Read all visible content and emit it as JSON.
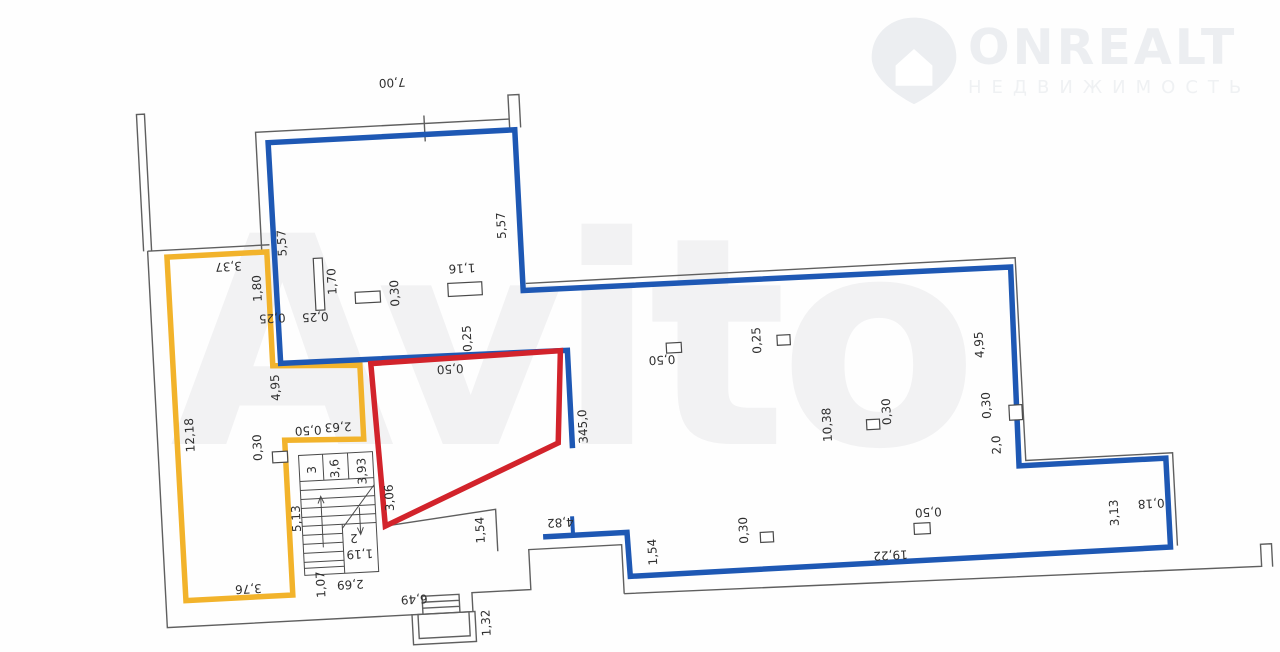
{
  "watermark": {
    "brand": "ONREALT",
    "brand_subtitle": "НЕДВИЖИМОСТЬ",
    "center_text": "Avito"
  },
  "plan": {
    "colors": {
      "blue": "#1e58b4",
      "yellow": "#f2b32b",
      "red": "#d2232b",
      "wall": "#5f5f5f",
      "stair": "#4a4a4a",
      "label": "#2e2e2e",
      "watermark_gray": "#f2f2f3",
      "logo_gray": "#eceef1"
    },
    "area_value": "345,0",
    "labels": [
      {
        "t": "7,00",
        "x": 407,
        "y": 69,
        "r": 180
      },
      {
        "t": "5,57",
        "x": 289,
        "y": 224,
        "r": -90
      },
      {
        "t": "5,57",
        "x": 509,
        "y": 218,
        "r": -90
      },
      {
        "t": "1,70",
        "x": 337,
        "y": 265,
        "r": -90
      },
      {
        "t": "0,30",
        "x": 399,
        "y": 280,
        "r": -90
      },
      {
        "t": "1,16",
        "x": 467,
        "y": 258,
        "r": 180
      },
      {
        "t": "3,37",
        "x": 234,
        "y": 244,
        "r": 180
      },
      {
        "t": "1,80",
        "x": 262,
        "y": 268,
        "r": -90
      },
      {
        "t": "0,25",
        "x": 275,
        "y": 298,
        "r": 180
      },
      {
        "t": "0,25",
        "x": 318,
        "y": 299,
        "r": 180
      },
      {
        "t": "4,95",
        "x": 275,
        "y": 368,
        "r": -90
      },
      {
        "t": "12,18",
        "x": 187,
        "y": 411,
        "r": -90
      },
      {
        "t": "2,63",
        "x": 335,
        "y": 410,
        "r": 180
      },
      {
        "t": "0,50",
        "x": 305,
        "y": 412,
        "r": 180
      },
      {
        "t": "0,30",
        "x": 254,
        "y": 427,
        "r": -90
      },
      {
        "t": "5,13",
        "x": 289,
        "y": 500,
        "r": -90
      },
      {
        "t": "3,76",
        "x": 237,
        "y": 567,
        "r": 180
      },
      {
        "t": "1,07",
        "x": 310,
        "y": 567,
        "r": -90
      },
      {
        "t": "3",
        "x": 307,
        "y": 452,
        "r": -90
      },
      {
        "t": "3,6",
        "x": 330,
        "y": 452,
        "r": -90
      },
      {
        "t": "3,93",
        "x": 357,
        "y": 456,
        "r": -90
      },
      {
        "t": "2",
        "x": 345,
        "y": 522,
        "r": 180
      },
      {
        "t": "1,19",
        "x": 350,
        "y": 538,
        "r": 180
      },
      {
        "t": "2,69",
        "x": 339,
        "y": 568,
        "r": 180
      },
      {
        "t": "6,49",
        "x": 402,
        "y": 586,
        "r": 180
      },
      {
        "t": "1,32",
        "x": 473,
        "y": 614,
        "r": -90
      },
      {
        "t": "1,54",
        "x": 472,
        "y": 521,
        "r": -90
      },
      {
        "t": "4,82",
        "x": 552,
        "y": 517,
        "r": 180
      },
      {
        "t": "1,54",
        "x": 643,
        "y": 552,
        "r": -90
      },
      {
        "t": "3,06",
        "x": 383,
        "y": 484,
        "r": -90
      },
      {
        "t": "345,0",
        "x": 580,
        "y": 423,
        "r": -90
      },
      {
        "t": "0,50",
        "x": 450,
        "y": 358,
        "r": 180
      },
      {
        "t": "0,25",
        "x": 469,
        "y": 329,
        "r": -90
      },
      {
        "t": "0,50",
        "x": 662,
        "y": 360,
        "r": 180
      },
      {
        "t": "0,25",
        "x": 758,
        "y": 346,
        "r": -90
      },
      {
        "t": "10,38",
        "x": 824,
        "y": 434,
        "r": -90
      },
      {
        "t": "0,30",
        "x": 884,
        "y": 424,
        "r": -90
      },
      {
        "t": "4,95",
        "x": 980,
        "y": 362,
        "r": -90
      },
      {
        "t": "0,30",
        "x": 984,
        "y": 423,
        "r": -90
      },
      {
        "t": "2,0",
        "x": 992,
        "y": 463,
        "r": -90
      },
      {
        "t": "0,30",
        "x": 735,
        "y": 535,
        "r": -90
      },
      {
        "t": "0,50",
        "x": 920,
        "y": 526,
        "r": 180
      },
      {
        "t": "19,22",
        "x": 880,
        "y": 567,
        "r": 180
      },
      {
        "t": "3,13",
        "x": 1106,
        "y": 537,
        "r": -90
      },
      {
        "t": "0,18",
        "x": 1143,
        "y": 529,
        "r": 180
      }
    ]
  }
}
